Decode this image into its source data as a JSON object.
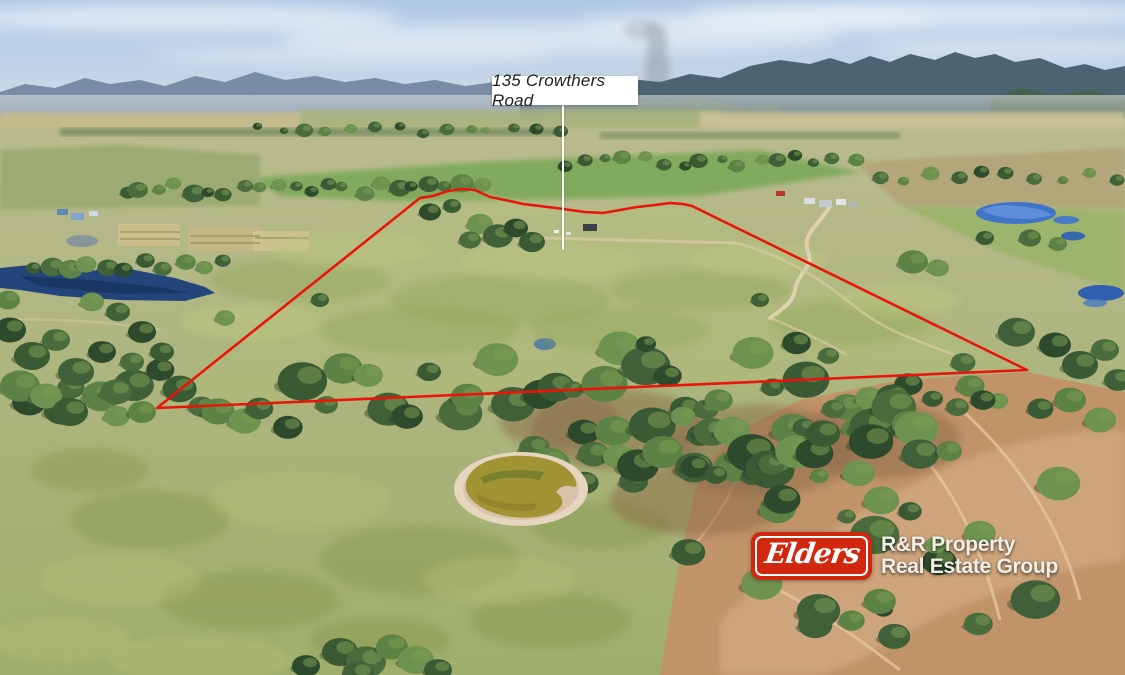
{
  "address_label": {
    "text": "135 Crowthers Road"
  },
  "branding": {
    "logo_text": "Elders",
    "agency_line1": "R&R Property",
    "agency_line2": "Real Estate Group",
    "logo_color": "#d2270f",
    "text_color": "#f1efe8"
  },
  "boundary": {
    "color": "#ea1508",
    "stroke_width": 2.6,
    "points": [
      [
        157,
        408
      ],
      [
        420,
        198
      ],
      [
        433,
        196
      ],
      [
        448,
        191
      ],
      [
        462,
        189
      ],
      [
        475,
        190
      ],
      [
        490,
        197
      ],
      [
        510,
        201
      ],
      [
        523,
        204
      ],
      [
        540,
        206
      ],
      [
        563,
        209
      ],
      [
        585,
        212
      ],
      [
        603,
        213
      ],
      [
        620,
        210
      ],
      [
        637,
        207
      ],
      [
        655,
        205
      ],
      [
        670,
        203
      ],
      [
        683,
        204
      ],
      [
        692,
        206
      ],
      [
        1027,
        370
      ],
      [
        157,
        408
      ]
    ]
  },
  "leader_line": {
    "from": [
      563,
      105
    ],
    "to": [
      563,
      250
    ],
    "color": "#ffffff"
  }
}
